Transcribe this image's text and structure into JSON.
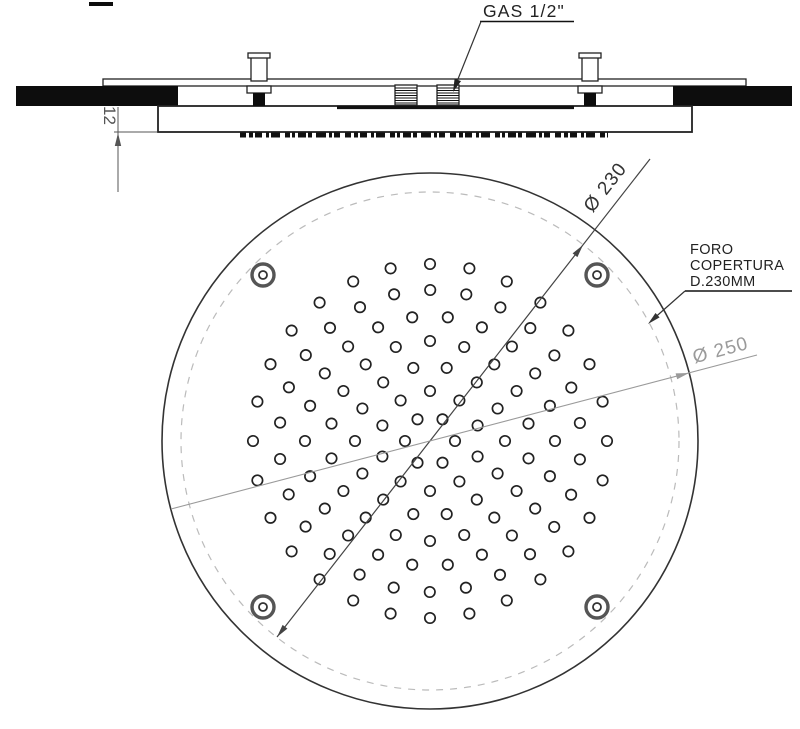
{
  "drawing": {
    "type": "technical-drawing",
    "subject": "round recessed ceiling shower head, section and plan views",
    "side_view": {
      "gas_connection_label": "GAS 1/2\"",
      "plate_thickness_dim": "12"
    },
    "top_view": {
      "cover_hole_dia_label": "Ø 230",
      "outer_dia_label": "Ø 250",
      "note_line1": "FORO",
      "note_line2": "COPERTURA",
      "note_line3": "D.230MM"
    },
    "nozzle_pattern": {
      "center_x": 430,
      "center_y": 441,
      "hole_radius": 5.2,
      "rings": [
        {
          "radius": 25,
          "count": 6,
          "offset_deg": 0
        },
        {
          "radius": 50,
          "count": 10,
          "offset_deg": 18
        },
        {
          "radius": 75,
          "count": 14,
          "offset_deg": 0
        },
        {
          "radius": 100,
          "count": 18,
          "offset_deg": 10
        },
        {
          "radius": 125,
          "count": 22,
          "offset_deg": 0
        },
        {
          "radius": 151,
          "count": 26,
          "offset_deg": 7
        },
        {
          "radius": 177,
          "count": 28,
          "offset_deg": 0
        }
      ]
    },
    "geometry": {
      "outer_circle_radius_px": 268,
      "cover_circle_radius_px": 249,
      "screw_positions": [
        {
          "x": 263,
          "y": 275
        },
        {
          "x": 597,
          "y": 275
        },
        {
          "x": 263,
          "y": 607
        },
        {
          "x": 597,
          "y": 607
        }
      ]
    },
    "colors": {
      "line": "#222222",
      "black_fill": "#0d0d0d",
      "dim_gray": "#9a9a9a",
      "dashed_circle": "#bbbbbb",
      "background": "#ffffff"
    }
  }
}
